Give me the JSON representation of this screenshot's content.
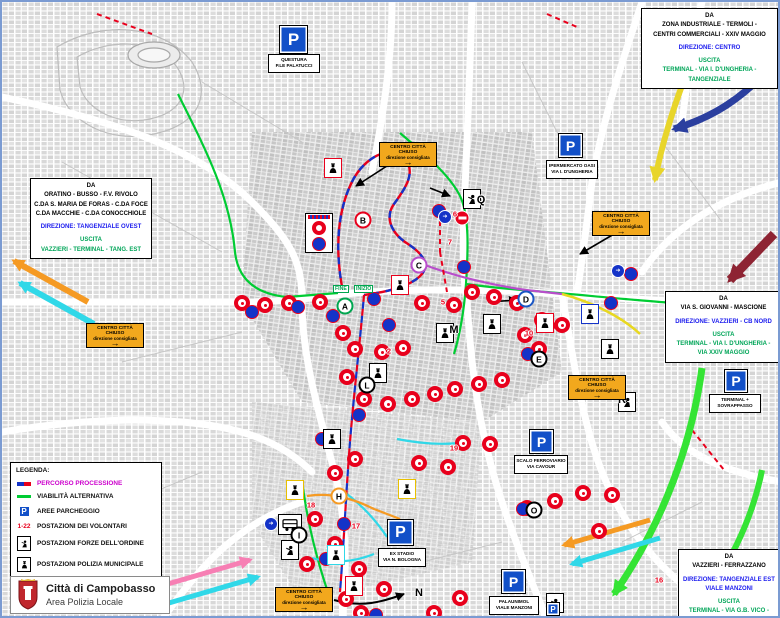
{
  "colors": {
    "parking_blue": "#1250c8",
    "closure_orange": "#f2a81d",
    "route_red": "#e8001c",
    "route_blue": "#1433c8",
    "alt_green": "#00cc33",
    "legend_magenta": "#cc00cc"
  },
  "boxes": {
    "top_right": {
      "da": "DA",
      "from1": "ZONA INDUSTRIALE - TERMOLI -",
      "from2": "CENTRI COMMERCIALI - XXIV MAGGIO",
      "direzione": "DIREZIONE: CENTRO",
      "uscita": "USCITA",
      "via1": "TERMINAL - VIA I. D'UNGHERIA - TANGENZIALE"
    },
    "left": {
      "da": "DA",
      "from1": "ORATINO - BUSSO - F.V. RIVOLO",
      "from2": "C.DA S. MARIA DE FORAS - C.DA FOCE",
      "from3": "C.DA MACCHIE - C.DA CONOCCHIOLE",
      "direzione": "DIREZIONE: TANGENZIALE OVEST",
      "uscita": "USCITA",
      "via1": "VAZZIERI - TERMINAL - TANG. EST"
    },
    "right": {
      "da": "DA",
      "from1": "VIA S. GIOVANNI - MASCIONE",
      "direzione": "DIREZIONE: VAZZIERI - CB NORD",
      "uscita": "USCITA",
      "via1": "TERMINAL - VIA I. D'UNGHERIA -",
      "via2": "VIA XXIV MAGGIO"
    },
    "bottom_right": {
      "da": "DA",
      "from1": "VAZZIERI - FERRAZZANO",
      "direzione1": "DIREZIONE: TANGENZIALE EST",
      "direzione2": "VIALE MANZONI",
      "uscita": "USCITA",
      "via1": "TERMINAL - VIA G.B. VICO -",
      "via2": "PALAUNIMOL"
    }
  },
  "legend": {
    "title": "LEGENDA:",
    "items": [
      {
        "label": "PERCORSO PROCESSIONE"
      },
      {
        "label": "VIABILITÀ ALTERNATIVA"
      },
      {
        "label": "AREE PARCHEGGIO"
      },
      {
        "label": "POSTAZIONI DEI VOLONTARI",
        "badge": "1-22"
      },
      {
        "label": "POSTAZIONI FORZE DELL'ORDINE"
      },
      {
        "label": "POSTAZIONI POLIZIA MUNICIPALE"
      }
    ]
  },
  "title_box": {
    "title": "Città di Campobasso",
    "subtitle": "Area Polizia Locale"
  },
  "road_closed": {
    "line1": "CENTRO CITTÀ CHIUSO",
    "line2": "direzione consigliata",
    "arrow": "→",
    "positions": [
      [
        377,
        140
      ],
      [
        590,
        209
      ],
      [
        84,
        321
      ],
      [
        566,
        373
      ],
      [
        273,
        585
      ]
    ]
  },
  "route_tags": {
    "fine": "FINE",
    "inizio": "INIZIO"
  },
  "parking_lots": [
    {
      "lines": [
        "QUESTURA",
        "P.LE PALATUCCI"
      ],
      "p": [
        277,
        23,
        27
      ],
      "label": [
        266,
        52,
        48
      ]
    },
    {
      "lines": [
        "IPERMERCATO OASI",
        "VIA I. D'UNGHERIA"
      ],
      "p": [
        556,
        131,
        23
      ],
      "label": [
        544,
        158,
        48
      ]
    },
    {
      "lines": [
        "TERMINAL +",
        "SOVRAPPASSO"
      ],
      "p": [
        722,
        367,
        22
      ],
      "label": [
        707,
        392,
        48
      ]
    },
    {
      "lines": [
        "SCALO FERROVIARIO",
        "VIA CAVOUR"
      ],
      "p": [
        527,
        427,
        23
      ],
      "label": [
        512,
        453,
        50
      ]
    },
    {
      "lines": [
        "EX STADIO",
        "VIA N. BOLOGNA"
      ],
      "p": [
        385,
        517,
        25
      ],
      "label": [
        376,
        546,
        44
      ]
    },
    {
      "lines": [
        "PALAUNIMOL",
        "VIALE MANZONI"
      ],
      "p": [
        499,
        567,
        23
      ],
      "label": [
        487,
        594,
        46
      ]
    }
  ],
  "map": {
    "letters": [
      {
        "t": "A",
        "x": 343,
        "y": 304,
        "c": "#00a650",
        "o": 1
      },
      {
        "t": "B",
        "x": 361,
        "y": 218,
        "c": "#e8001c",
        "o": 1
      },
      {
        "t": "C",
        "x": 417,
        "y": 263,
        "c": "#b84ecb",
        "o": 1
      },
      {
        "t": "D",
        "x": 524,
        "y": 297,
        "c": "#1a56c4",
        "o": 1
      },
      {
        "t": "E",
        "x": 537,
        "y": 357,
        "c": "#000000",
        "o": 1
      },
      {
        "t": "H",
        "x": 337,
        "y": 494,
        "c": "#f59a23",
        "o": 1
      },
      {
        "t": "I",
        "x": 297,
        "y": 533,
        "c": "#000000",
        "o": 1
      },
      {
        "t": "L",
        "x": 365,
        "y": 383,
        "c": "#000000",
        "o": 1
      },
      {
        "t": "O",
        "x": 532,
        "y": 508,
        "c": "#000000",
        "o": 1
      },
      {
        "t": "M",
        "x": 452,
        "y": 328,
        "o": 0
      },
      {
        "t": "N",
        "x": 417,
        "y": 591,
        "o": 0
      },
      {
        "t": "Q",
        "x": 479,
        "y": 198,
        "o": 0
      },
      {
        "t": "R",
        "x": 620,
        "y": 398,
        "o": 0
      }
    ],
    "numbers": [
      {
        "t": "2",
        "x": 387,
        "y": 349
      },
      {
        "t": "5",
        "x": 441,
        "y": 300
      },
      {
        "t": "6",
        "x": 453,
        "y": 212
      },
      {
        "t": "7",
        "x": 448,
        "y": 240
      },
      {
        "t": "10",
        "x": 527,
        "y": 331
      },
      {
        "t": "16",
        "x": 657,
        "y": 578
      },
      {
        "t": "17",
        "x": 354,
        "y": 524
      },
      {
        "t": "18",
        "x": 309,
        "y": 503
      },
      {
        "t": "19",
        "x": 452,
        "y": 446
      }
    ],
    "circles_red": [
      [
        240,
        301
      ],
      [
        263,
        303
      ],
      [
        287,
        301
      ],
      [
        318,
        300
      ],
      [
        341,
        331
      ],
      [
        353,
        347
      ],
      [
        380,
        350
      ],
      [
        401,
        346
      ],
      [
        420,
        301
      ],
      [
        452,
        303
      ],
      [
        470,
        290
      ],
      [
        492,
        295
      ],
      [
        515,
        301
      ],
      [
        540,
        318
      ],
      [
        560,
        323
      ],
      [
        523,
        333
      ],
      [
        537,
        347
      ],
      [
        345,
        375
      ],
      [
        362,
        397
      ],
      [
        386,
        402
      ],
      [
        410,
        397
      ],
      [
        433,
        392
      ],
      [
        453,
        387
      ],
      [
        477,
        382
      ],
      [
        500,
        378
      ],
      [
        461,
        441
      ],
      [
        488,
        442
      ],
      [
        446,
        465
      ],
      [
        417,
        461
      ],
      [
        353,
        457
      ],
      [
        333,
        471
      ],
      [
        313,
        517
      ],
      [
        333,
        542
      ],
      [
        357,
        567
      ],
      [
        382,
        587
      ],
      [
        344,
        597
      ],
      [
        305,
        562
      ],
      [
        610,
        493
      ],
      [
        581,
        491
      ],
      [
        553,
        499
      ],
      [
        525,
        506
      ],
      [
        597,
        529
      ],
      [
        432,
        611
      ],
      [
        458,
        596
      ],
      [
        359,
        611
      ]
    ],
    "circles_blue": [
      [
        250,
        310
      ],
      [
        296,
        305
      ],
      [
        331,
        314
      ],
      [
        372,
        297
      ],
      [
        437,
        209
      ],
      [
        462,
        265
      ],
      [
        526,
        352
      ],
      [
        546,
        324
      ],
      [
        320,
        437
      ],
      [
        342,
        522
      ],
      [
        324,
        557
      ],
      [
        302,
        592
      ],
      [
        374,
        613
      ],
      [
        521,
        507
      ],
      [
        609,
        301
      ],
      [
        629,
        272
      ],
      [
        387,
        323
      ],
      [
        357,
        413
      ]
    ],
    "no_entry": [
      [
        460,
        216
      ]
    ],
    "direction_signs": [
      [
        443,
        215
      ],
      [
        616,
        269
      ],
      [
        269,
        522
      ]
    ],
    "police_force": [
      [
        470,
        197,
        "#000000"
      ],
      [
        625,
        400,
        "#000000"
      ],
      [
        288,
        548,
        "#000000"
      ],
      [
        553,
        601,
        "#000000"
      ]
    ],
    "police_municipal": [
      [
        331,
        166,
        "#e8001c"
      ],
      [
        398,
        283,
        "#e8001c"
      ],
      [
        443,
        331,
        "#000000"
      ],
      [
        490,
        322,
        "#000000"
      ],
      [
        543,
        321,
        "#e8001c"
      ],
      [
        376,
        371,
        "#000000"
      ],
      [
        330,
        437,
        "#000000"
      ],
      [
        293,
        488,
        "#e8c000"
      ],
      [
        334,
        553,
        "#30d8e8"
      ],
      [
        352,
        584,
        "#e8001c"
      ],
      [
        405,
        487,
        "#e8c000"
      ],
      [
        588,
        312,
        "#1433c8"
      ],
      [
        608,
        347,
        "#000000"
      ]
    ]
  }
}
